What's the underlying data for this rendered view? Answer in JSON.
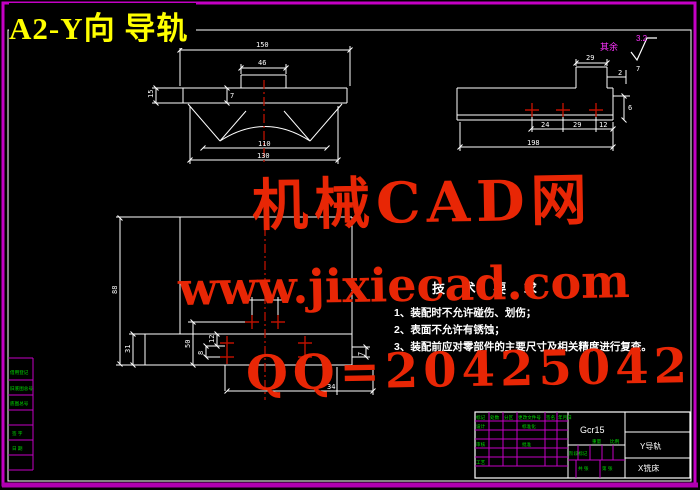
{
  "title": {
    "text": "A2-Y向 导轨"
  },
  "watermark": {
    "brand": "机械CAD网",
    "url": "www.jixiecad.com",
    "qq": "QQ=20425042",
    "color": "#e82605"
  },
  "finish": {
    "note": "其余",
    "value": "3.2"
  },
  "tech": {
    "heading": "技 术 要 求",
    "item1": "1、装配时不允许碰伤、划伤；",
    "item2": "2、表面不允许有锈蚀；",
    "item3": "3、装配前应对零部件的主要尺寸及相关精度进行复查。"
  },
  "dims": {
    "sec_top": "150",
    "sec_boss": "46",
    "sec_h": "15",
    "sec_step": "7",
    "sec_arc": "110",
    "sec_bottom": "130",
    "side_boss": "29",
    "side_g1": "2",
    "side_g2": "7",
    "side_p1": "24",
    "side_p2": "29",
    "side_p3": "12",
    "side_len": "198",
    "side_h": "6",
    "plan_h": "88",
    "plan_31": "31",
    "plan_50": "50",
    "plan_12": "12",
    "plan_8": "8",
    "plan_34": "34",
    "plan_7": "7"
  },
  "titleblock": {
    "material": "Gcr15",
    "part": "Y导轨",
    "org": "X铣床",
    "labels": {
      "mark": "标记",
      "count": "处数",
      "zone": "分区",
      "doc": "更改文件号",
      "sign": "签名",
      "date": "年月日",
      "design": "设计",
      "check": "审核",
      "process": "工艺",
      "std": "标准化",
      "approve": "批准",
      "stage": "阶段标记",
      "weight": "重量",
      "scale": "比例",
      "sheet": "共 张",
      "page": "第 张"
    }
  },
  "sidebar": {
    "rows": [
      "借用登记",
      "旧底图总号",
      "底图总号",
      "签 字",
      "日 期"
    ]
  },
  "colors": {
    "border": "#cc00cc",
    "lines": "#ffffff",
    "accent_red": "#bb1100",
    "text_green": "#00dc00",
    "title_yellow": "#ffff00"
  }
}
